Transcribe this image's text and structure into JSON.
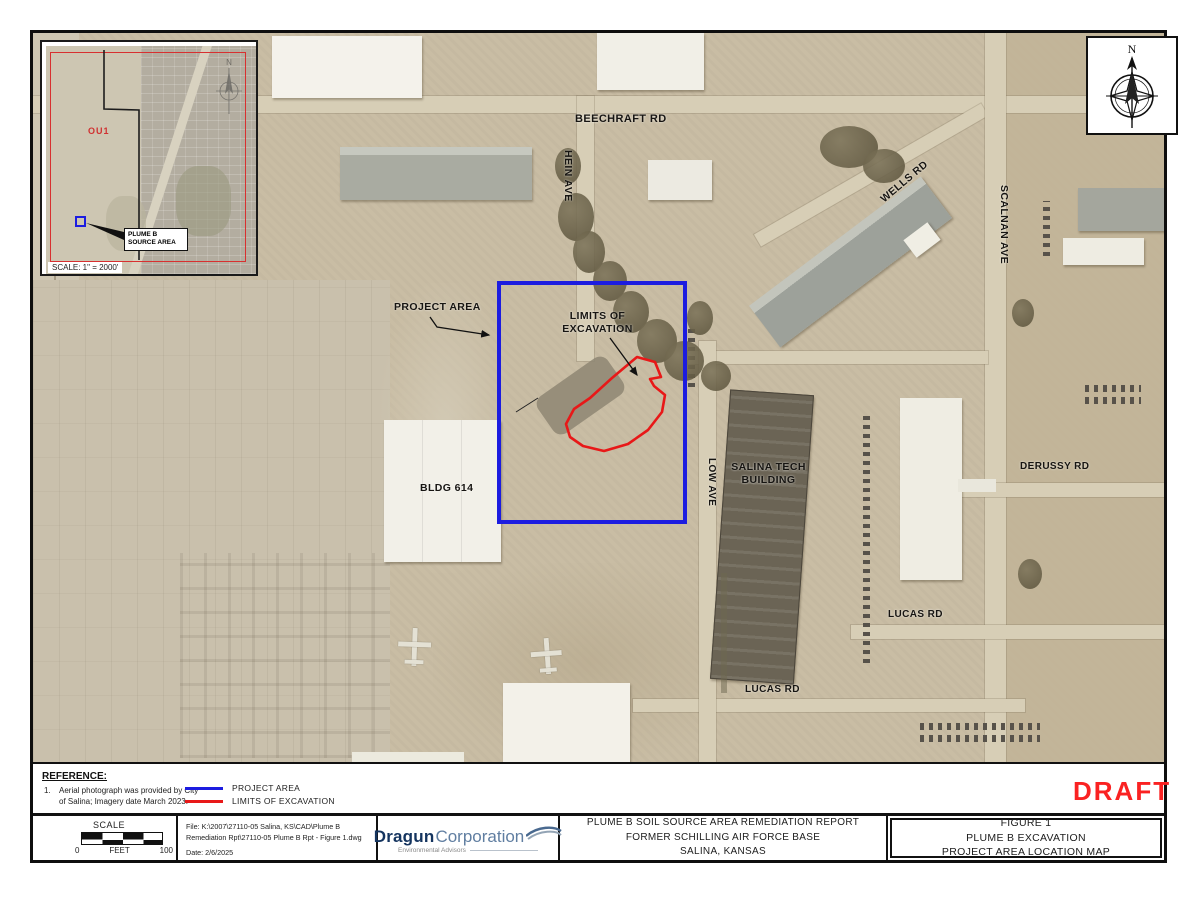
{
  "map_labels": {
    "beechcraft_rd": "BEECHRAFT RD",
    "hein_ave": "HEIN AVE",
    "wells_rd": "WELLS RD",
    "scalnan_ave": "SCALNAN AVE",
    "derussy_rd": "DERUSSY RD",
    "lucas_rd_east": "LUCAS RD",
    "lucas_rd_south": "LUCAS RD",
    "low_ave": "LOW AVE",
    "salina_tech_line1": "SALINA TECH",
    "salina_tech_line2": "BUILDING",
    "bldg_614": "BLDG 614",
    "project_area": "PROJECT AREA",
    "limits_line1": "LIMITS OF",
    "limits_line2": "EXCAVATION"
  },
  "inset": {
    "ou_label": "OU1",
    "callout_line1": "PLUME B",
    "callout_line2": "SOURCE AREA",
    "scale_note": "SCALE: 1\" = 2000'",
    "north": "N"
  },
  "compass": {
    "north": "N"
  },
  "reference": {
    "heading": "REFERENCE:",
    "item_number": "1.",
    "item_line1": "Aerial photograph was provided by City",
    "item_line2": "of Salina; Imagery date March 2023."
  },
  "legend": {
    "project_area": "PROJECT AREA",
    "limits_of_excavation": "LIMITS OF EXCAVATION"
  },
  "draft_label": "DRAFT",
  "title_block": {
    "scale_label": "SCALE",
    "scale_zero": "0",
    "scale_units": "FEET",
    "scale_max": "100",
    "file_line1": "File: K:\\2007\\27110-05 Salina, KS\\CAD\\Plume B",
    "file_line2": "Remediation Rpt\\27110-05 Plume B Rpt - Figure 1.dwg",
    "date_line": "Date: 2/6/2025",
    "logo_name_bold": "Dragun",
    "logo_name_light": "Corporation",
    "logo_tagline": "Environmental Advisors",
    "project_title_line1": "PLUME B SOIL SOURCE AREA REMEDIATION REPORT",
    "project_title_line2": "FORMER SCHILLING AIR FORCE BASE",
    "project_title_line3": "SALINA, KANSAS",
    "figure_line1": "FIGURE 1",
    "figure_line2": "PLUME B EXCAVATION",
    "figure_line3": "PROJECT AREA LOCATION MAP"
  },
  "colors": {
    "project_area_outline": "#1c1ce0",
    "excavation_outline": "#e81818",
    "draft_text": "#fa2222"
  }
}
